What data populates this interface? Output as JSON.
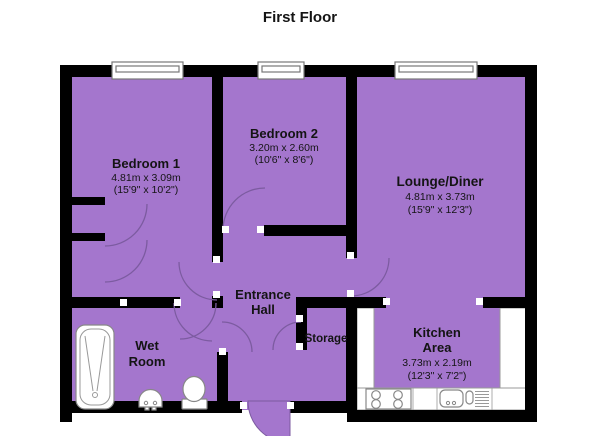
{
  "title": "First Floor",
  "colors": {
    "room_fill": "#A476CD",
    "wall": "#000000",
    "door_arc": "#7C5BA0",
    "fixture_stroke": "#888888",
    "text": "#141414"
  },
  "rooms": {
    "bedroom1": {
      "name": "Bedroom 1",
      "metric": "4.81m x 3.09m",
      "imperial": "(15'9\" x 10'2\")"
    },
    "bedroom2": {
      "name": "Bedroom 2",
      "metric": "3.20m x 2.60m",
      "imperial": "(10'6\" x 8'6\")"
    },
    "lounge": {
      "name": "Lounge/Diner",
      "metric": "4.81m x 3.73m",
      "imperial": "(15'9\" x 12'3\")"
    },
    "kitchen": {
      "name_line1": "Kitchen",
      "name_line2": "Area",
      "metric": "3.73m x 2.19m",
      "imperial": "(12'3\" x 7'2\")"
    },
    "entrance_hall": {
      "name_line1": "Entrance",
      "name_line2": "Hall"
    },
    "storage": {
      "name": "Storage"
    },
    "wet_room": {
      "name_line1": "Wet",
      "name_line2": "Room"
    }
  },
  "fixtures": {
    "wet_room": [
      "bathtub",
      "basin",
      "toilet"
    ],
    "kitchen": [
      "hob",
      "sink-with-drainer",
      "worktop"
    ]
  },
  "windows": [
    "bedroom1-window",
    "bedroom2-window",
    "lounge-window"
  ]
}
